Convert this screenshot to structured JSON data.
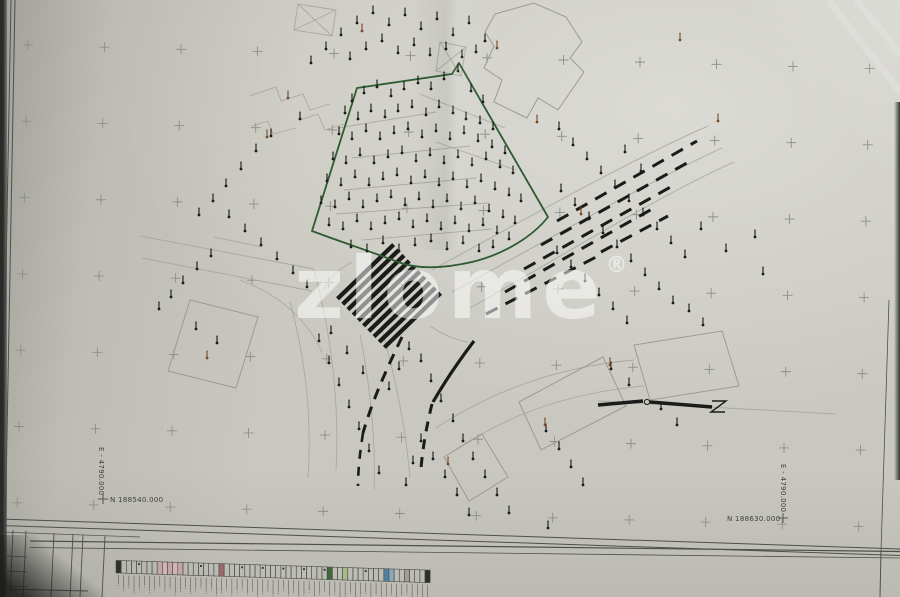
{
  "sheet": {
    "paper_color": "#c9c8c0",
    "backdrop_color": "#2a2a28",
    "line_faint": "#a9a9a1",
    "line_building": "#9b9b93",
    "line_frame": "#4f4f4a",
    "line_bold": "#1b1b19",
    "green": "#2e5b31",
    "brown": "#7a4a28",
    "cross_color": "#8e8e88",
    "label_color": "#3f3f3c"
  },
  "labels": [
    {
      "text": "E - 4790.000",
      "x": 99,
      "y": 447,
      "rot": 90,
      "size": 7
    },
    {
      "text": "N 188540.000",
      "x": 110,
      "y": 502,
      "size": 7,
      "cross": [
        103,
        499
      ]
    },
    {
      "text": "E - 4790.000",
      "x": 781,
      "y": 464,
      "rot": 90,
      "size": 7
    },
    {
      "text": "N 188630.000",
      "x": 727,
      "y": 521,
      "size": 7,
      "cross": [
        783,
        518
      ]
    }
  ],
  "watermark": {
    "text": "zlome",
    "reg": "®",
    "x": 294,
    "y": 318,
    "size": 86,
    "color": "rgba(255,255,255,0.52)"
  },
  "grid": {
    "x0": 28,
    "y0": 45,
    "dx": 76.5,
    "dy": 76.3,
    "cols": 12,
    "rows": 7,
    "xtilt": 1.8,
    "ytilt": 0.028
  },
  "geometry": {
    "faint_paths": [
      "M432,270 C520,222 630,160 708,126",
      "M452,292 C540,244 648,182 722,148",
      "M470,308 C552,262 658,196 734,162",
      "M140,236 L314,269",
      "M142,258 L312,291",
      "M314,270 C330,330 340,396 336,470",
      "M290,302 C306,360 312,420 308,478",
      "M382,330 C396,380 406,430 410,478",
      "M360,334 C370,386 376,438 374,490",
      "M240,280 C278,294 306,318 322,352",
      "M436,428 C500,386 566,366 634,360",
      "M452,452 C514,410 578,392 644,386",
      "M338,128 L436,112",
      "M352,158 L470,146",
      "M344,190 L476,178",
      "M336,214 L488,203",
      "M362,240 L492,229",
      "M420,94 L505,128",
      "M436,142 L516,170",
      "M250,96 L276,87 L281,101 L303,94 L310,110 L330,104",
      "M252,126 L268,121 L273,134 L296,128",
      "M300,120 L318,114 L325,130 L344,124",
      "M298,4 L336,10 L332,36 L294,30 Z",
      "M298,4 L332,36 M336,10 L294,30",
      "M440,42 L466,47 L461,76 L436,71 Z",
      "M440,42 L461,76 M466,47 L436,71",
      "M598,401 L836,414",
      "M352,262 C340,268 330,278 324,290",
      "M430,326 C442,334 454,340 468,342",
      "M214,237 L262,247"
    ],
    "buildings": [
      [
        [
          495,
          14
        ],
        [
          534,
          3
        ],
        [
          566,
          17
        ],
        [
          582,
          42
        ],
        [
          570,
          58
        ],
        [
          584,
          72
        ],
        [
          558,
          110
        ],
        [
          538,
          98
        ],
        [
          527,
          118
        ],
        [
          494,
          102
        ],
        [
          502,
          80
        ],
        [
          484,
          68
        ],
        [
          494,
          46
        ],
        [
          485,
          32
        ]
      ],
      [
        [
          190,
          300
        ],
        [
          258,
          317
        ],
        [
          236,
          388
        ],
        [
          168,
          371
        ]
      ],
      [
        [
          444,
          457
        ],
        [
          482,
          434
        ],
        [
          508,
          477
        ],
        [
          469,
          501
        ]
      ],
      [
        [
          519,
          402
        ],
        [
          603,
          357
        ],
        [
          626,
          406
        ],
        [
          541,
          450
        ]
      ],
      [
        [
          634,
          345
        ],
        [
          722,
          331
        ],
        [
          739,
          386
        ],
        [
          650,
          400
        ]
      ]
    ],
    "road_dashes": [
      [
        557,
        221,
        697,
        141
      ],
      [
        541,
        245,
        694,
        159
      ],
      [
        524,
        269,
        676,
        184
      ],
      [
        505,
        292,
        652,
        209
      ],
      [
        486,
        314,
        598,
        256
      ],
      [
        601,
        252,
        668,
        216
      ]
    ],
    "bold_paths": [
      {
        "d": "M474,341 C458,362 444,383 433,402",
        "w": 3.2
      },
      {
        "d": "M402,337 C389,364 373,398 363,433",
        "w": 3,
        "dash": "11 8"
      },
      {
        "d": "M432,404 C427,424 423,446 421,468",
        "w": 3,
        "dash": "10 8"
      },
      {
        "d": "M363,433 C360,452 358,470 358,486",
        "w": 2.6,
        "dash": "9 8"
      }
    ],
    "wall_paths": [
      {
        "d": "M598,405 L643,401",
        "w": 3.5
      },
      {
        "d": "M650,402 L712,407",
        "w": 3.5
      },
      {
        "d": "M712,401 L726,401 L711,412 L725,412",
        "w": 1.4
      }
    ],
    "wall_circle": [
      647,
      402,
      2.6
    ],
    "green_path": "M357,88 L452,74 L459,63 L548,217 C533,236 505,254 472,262 C441,269 416,269 398,262 C375,253 344,243 312,231 Z",
    "crosswalk": {
      "cx": 389,
      "cy": 296,
      "angle": -44,
      "count": 10,
      "len": 78,
      "bar": 4.3,
      "gap": 7.5
    },
    "frame_lines": [
      [
        0,
        519,
        900,
        549,
        1
      ],
      [
        0,
        525.5,
        900,
        555.5,
        1
      ],
      [
        30,
        541,
        900,
        551.5,
        1.2
      ],
      [
        30,
        547.5,
        900,
        558,
        0.8
      ],
      [
        11,
        0,
        0,
        597,
        1
      ],
      [
        15,
        0,
        4,
        597,
        1
      ],
      [
        889,
        300,
        881,
        551,
        0.8
      ],
      [
        881,
        551,
        880,
        597,
        1
      ],
      [
        13,
        530,
        10,
        597,
        0.9
      ],
      [
        26,
        531,
        23,
        597,
        0.9
      ],
      [
        54,
        533,
        51,
        597,
        0.9
      ],
      [
        73,
        534,
        70,
        597,
        0.9
      ],
      [
        83,
        535,
        80,
        597,
        0.9
      ],
      [
        105,
        536,
        102,
        597,
        0.9
      ],
      [
        7,
        556,
        27,
        557,
        0.8
      ],
      [
        7,
        571,
        27,
        572,
        0.8
      ],
      [
        6,
        586,
        27,
        587,
        0.8
      ],
      [
        0,
        589,
        88,
        591,
        1
      ],
      [
        0,
        532,
        140,
        537,
        0.7
      ]
    ],
    "shine_paths": [
      "M828,0 L900,92",
      "M856,0 L900,54"
    ],
    "points_black": [
      352,
      101,
      364,
      93,
      377,
      87,
      391,
      96,
      404,
      89,
      418,
      83,
      431,
      89,
      444,
      79,
      458,
      71,
      471,
      91,
      483,
      102,
      345,
      113,
      358,
      119,
      371,
      111,
      385,
      117,
      398,
      111,
      412,
      107,
      426,
      115,
      439,
      107,
      453,
      113,
      466,
      119,
      480,
      123,
      493,
      129,
      339,
      134,
      352,
      139,
      366,
      131,
      380,
      139,
      394,
      133,
      408,
      129,
      422,
      137,
      436,
      131,
      450,
      139,
      464,
      133,
      478,
      141,
      492,
      147,
      505,
      153,
      333,
      159,
      346,
      163,
      360,
      155,
      374,
      163,
      388,
      157,
      402,
      153,
      416,
      161,
      430,
      155,
      444,
      163,
      458,
      157,
      472,
      165,
      486,
      159,
      500,
      167,
      513,
      173,
      327,
      181,
      341,
      185,
      355,
      177,
      369,
      185,
      383,
      179,
      397,
      175,
      411,
      183,
      425,
      177,
      439,
      185,
      453,
      179,
      467,
      187,
      481,
      181,
      495,
      189,
      509,
      195,
      521,
      201,
      321,
      203,
      335,
      207,
      349,
      199,
      363,
      207,
      377,
      201,
      391,
      197,
      405,
      205,
      419,
      199,
      433,
      207,
      447,
      201,
      461,
      209,
      475,
      203,
      489,
      211,
      503,
      217,
      515,
      223,
      329,
      225,
      343,
      229,
      357,
      221,
      371,
      229,
      385,
      223,
      399,
      219,
      413,
      227,
      427,
      221,
      441,
      229,
      455,
      223,
      469,
      231,
      483,
      225,
      497,
      233,
      509,
      239,
      351,
      247,
      367,
      251,
      383,
      243,
      399,
      251,
      415,
      245,
      431,
      241,
      447,
      249,
      463,
      243,
      479,
      251,
      493,
      247,
      311,
      63,
      326,
      49,
      341,
      35,
      357,
      23,
      373,
      13,
      389,
      25,
      405,
      15,
      421,
      29,
      437,
      19,
      453,
      35,
      469,
      23,
      485,
      41,
      350,
      59,
      366,
      49,
      382,
      41,
      398,
      53,
      414,
      45,
      430,
      55,
      446,
      49,
      462,
      57,
      476,
      52,
      300,
      119,
      271,
      136,
      256,
      151,
      241,
      169,
      226,
      186,
      213,
      201,
      199,
      215,
      229,
      217,
      245,
      231,
      261,
      245,
      277,
      259,
      293,
      273,
      307,
      287,
      211,
      256,
      197,
      269,
      183,
      283,
      171,
      297,
      159,
      309,
      196,
      329,
      217,
      343,
      559,
      129,
      573,
      145,
      587,
      159,
      601,
      173,
      615,
      187,
      629,
      201,
      643,
      215,
      657,
      229,
      671,
      243,
      685,
      257,
      561,
      191,
      575,
      205,
      589,
      219,
      603,
      233,
      617,
      247,
      631,
      261,
      645,
      275,
      659,
      289,
      673,
      303,
      557,
      253,
      571,
      267,
      585,
      281,
      599,
      295,
      613,
      309,
      627,
      323,
      755,
      237,
      763,
      274,
      726,
      251,
      701,
      229,
      689,
      311,
      703,
      325,
      641,
      171,
      625,
      152,
      319,
      341,
      329,
      363,
      339,
      385,
      349,
      407,
      359,
      429,
      369,
      451,
      379,
      473,
      331,
      333,
      347,
      353,
      363,
      373,
      409,
      349,
      399,
      369,
      389,
      389,
      421,
      361,
      431,
      381,
      441,
      401,
      453,
      421,
      463,
      441,
      473,
      459,
      485,
      477,
      497,
      495,
      421,
      441,
      413,
      463,
      406,
      485,
      433,
      459,
      445,
      477,
      457,
      495,
      546,
      431,
      559,
      449,
      571,
      467,
      583,
      485,
      611,
      369,
      629,
      385,
      661,
      409,
      677,
      425,
      548,
      528,
      469,
      515,
      509,
      513
    ],
    "points_brown": [
      288,
      98,
      267,
      137,
      207,
      358,
      497,
      48,
      680,
      40,
      610,
      365,
      545,
      425,
      448,
      464,
      362,
      31,
      718,
      121,
      537,
      122,
      581,
      214
    ]
  },
  "legend": {
    "x0": 116,
    "y0": 560.5,
    "slope": 0.031,
    "cell_w": 5.15,
    "cell_h": 12.5,
    "count": 61,
    "border": "#4b4b47",
    "tick_color": "#5a564f",
    "colored": {
      "0": "#2e2e2a",
      "8": "#c2a6a6",
      "9": "#cfb4b4",
      "10": "#c2a6a6",
      "11": "#cfb4b4",
      "12": "#c2a6a6",
      "20": "#9a6a6a",
      "41": "#41663b",
      "44": "#a6bd85",
      "52": "#53809f",
      "53": "#8aa9bd",
      "56": "#a09e97",
      "60": "#2e2e2a"
    }
  }
}
